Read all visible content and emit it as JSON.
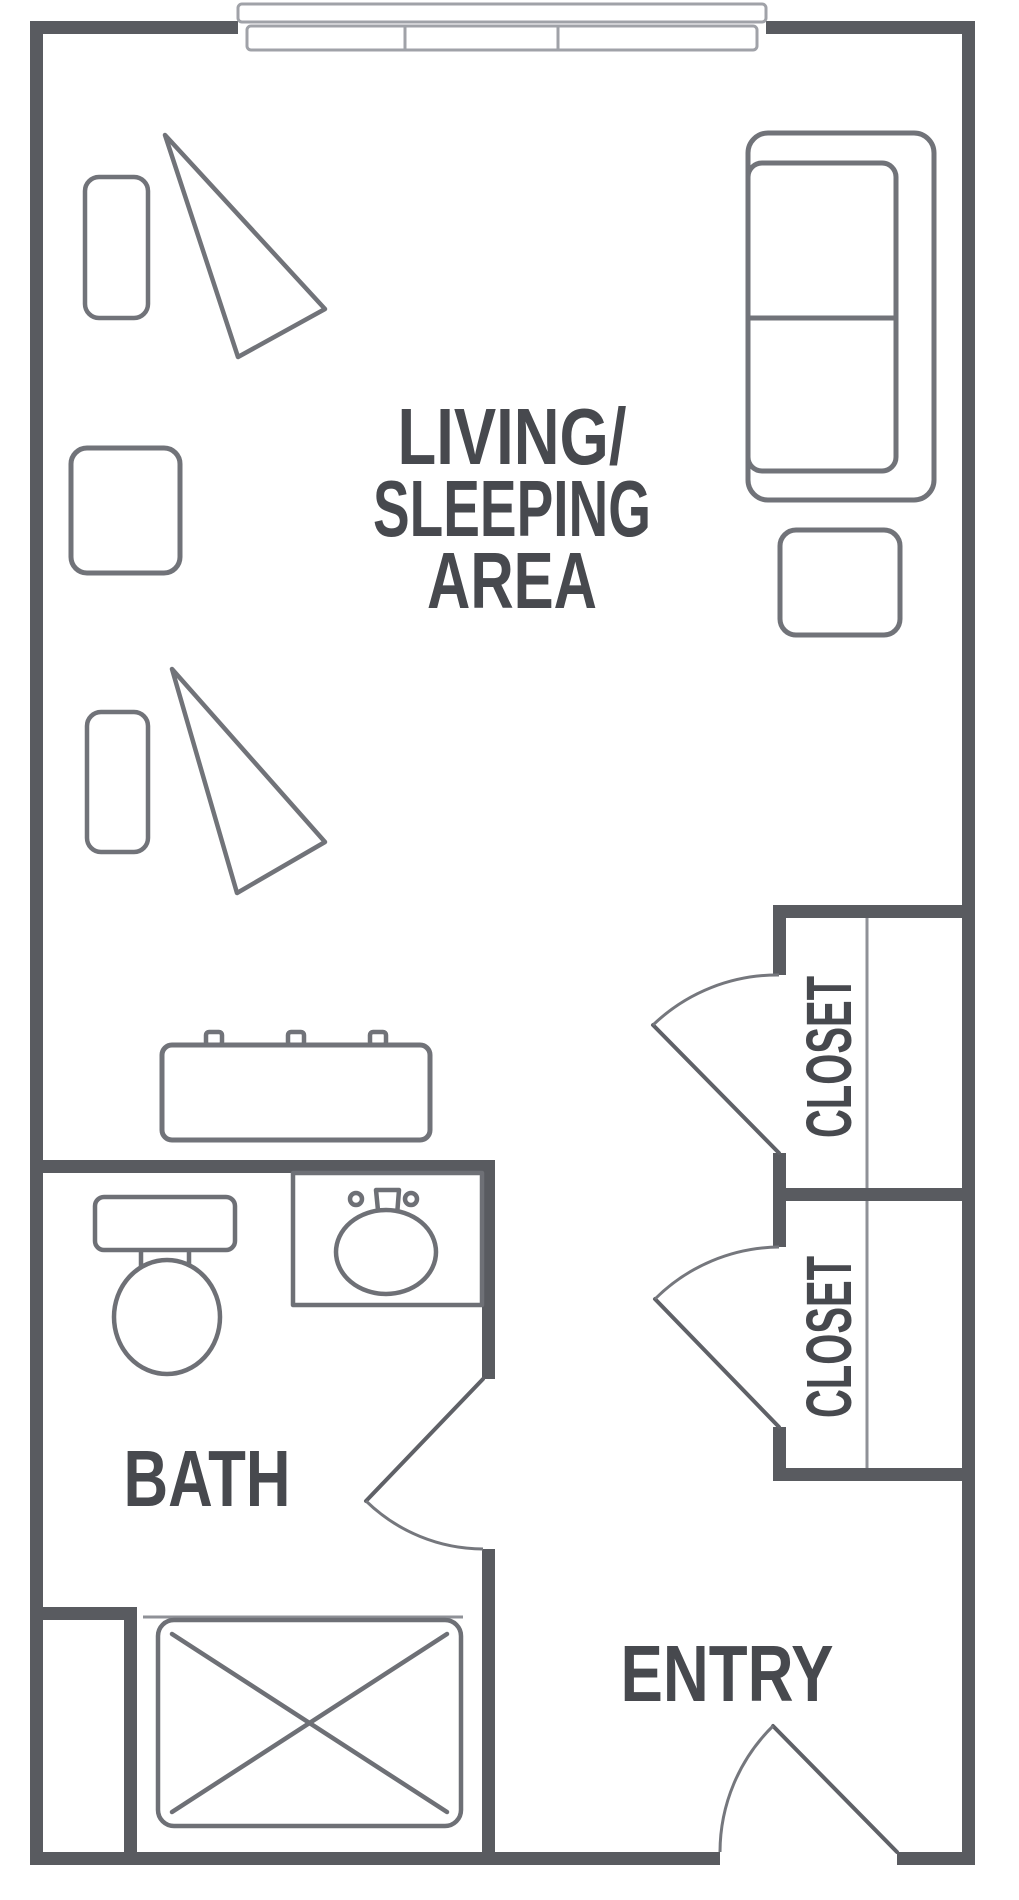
{
  "title": "Studio apartment floor plan",
  "labels": {
    "living_area_line1": "LIVING/",
    "living_area_line2": "SLEEPING",
    "living_area_line3": "AREA",
    "bath": "BATH",
    "entry": "ENTRY",
    "closet_upper": "CLOSET",
    "closet_lower": "CLOSET"
  },
  "rooms": [
    "LIVING/SLEEPING AREA",
    "BATH",
    "ENTRY",
    "CLOSET",
    "CLOSET"
  ],
  "furniture_icons": [
    "sofa-icon",
    "side-table-icon",
    "armchair-icon",
    "chaise-icon",
    "square-table-icon",
    "dresser-icon",
    "toilet-icon",
    "sink-icon",
    "shower-icon",
    "window-icon",
    "door-swing-icon",
    "closet-rod-icon"
  ],
  "colors": {
    "wall": "#595b60",
    "furniture_line": "#717379",
    "fixture_line": "#6e7076",
    "window_line": "#a0a2a8",
    "door_leaf": "#5f6167",
    "door_arc": "#75777d",
    "text": "#47494e",
    "background": "#ffffff"
  }
}
